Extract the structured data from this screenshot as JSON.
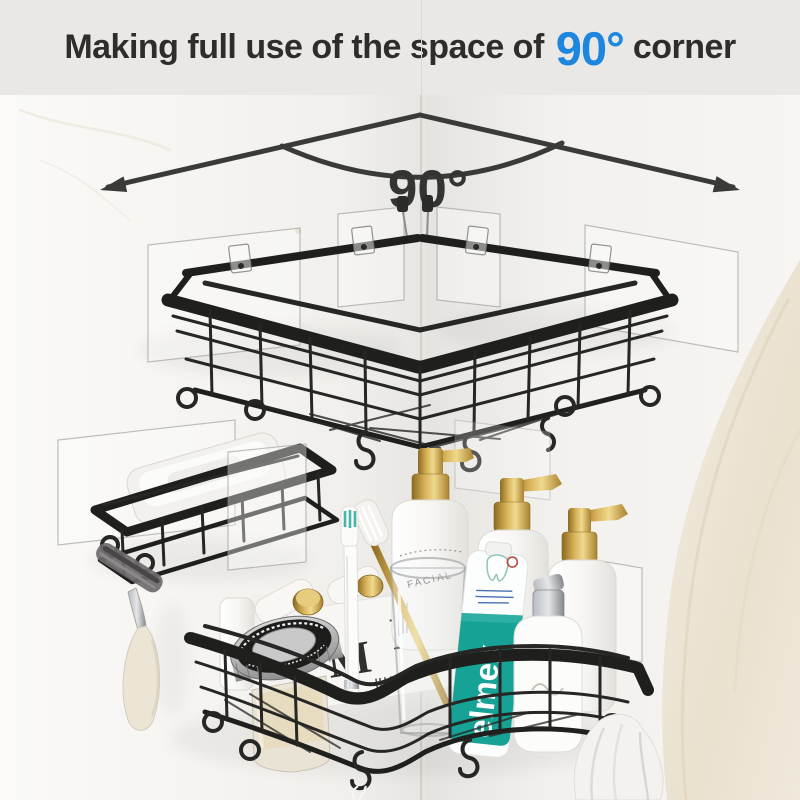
{
  "banner": {
    "title_prefix": "Making full use of the space of",
    "angle_text": "90°",
    "title_suffix": "corner",
    "text_color": "#2e2d2b",
    "highlight_color": "#1d87e0",
    "background": "#e9e8e5"
  },
  "annotation": {
    "angle_label": "90°",
    "line_color": "#3a3a38"
  },
  "products": {
    "toothpaste_brand": "elmex",
    "monogram_letter": "M",
    "bottle_small_text": "FACIAL",
    "toothpaste_band_color": "#17a296",
    "pump_gold_color": "#c9a24a",
    "frame_metal_color": "#1f1f1d"
  }
}
